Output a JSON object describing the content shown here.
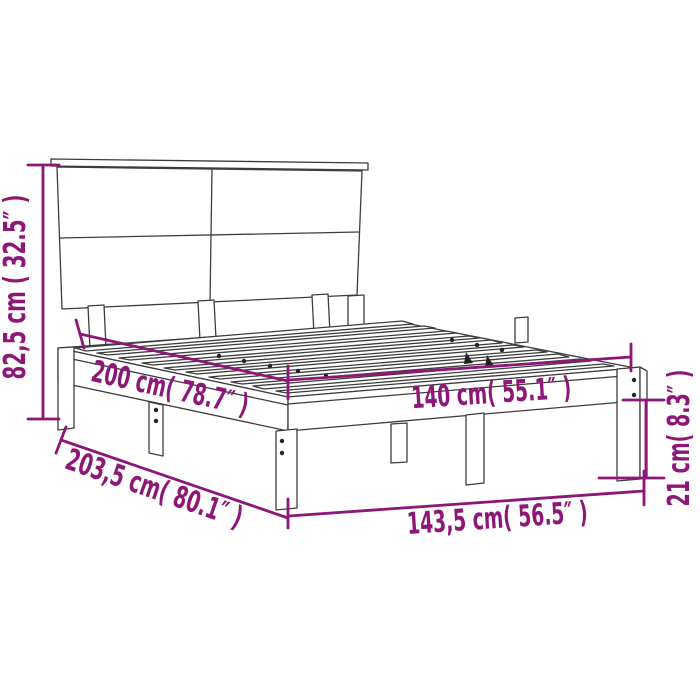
{
  "diagram": {
    "type": "product dimension diagram",
    "subject": "wooden bed frame with headboard and slatted base",
    "background_color": "#ffffff",
    "drawing_line_color": "#3d3d3d",
    "dimension_color": "#8d1777",
    "dimensions": {
      "headboard_height": {
        "label": "82,5 cm ( 32.5″ )",
        "cm": "82,5",
        "inches": "32.5"
      },
      "bed_length": {
        "label": "200 cm( 78.7″ )",
        "cm": "200",
        "inches": "78.7"
      },
      "bed_width": {
        "label": "140 cm( 55.1″ )",
        "cm": "140",
        "inches": "55.1"
      },
      "frame_total_length": {
        "label": "203,5 cm( 80.1″ )",
        "cm": "203,5",
        "inches": "80.1"
      },
      "frame_total_width": {
        "label": "143,5 cm( 56.5″ )",
        "cm": "143,5",
        "inches": "56.5"
      },
      "frame_height": {
        "label": "21 cm( 8.3″ )",
        "cm": "21",
        "inches": "8.3"
      }
    }
  }
}
